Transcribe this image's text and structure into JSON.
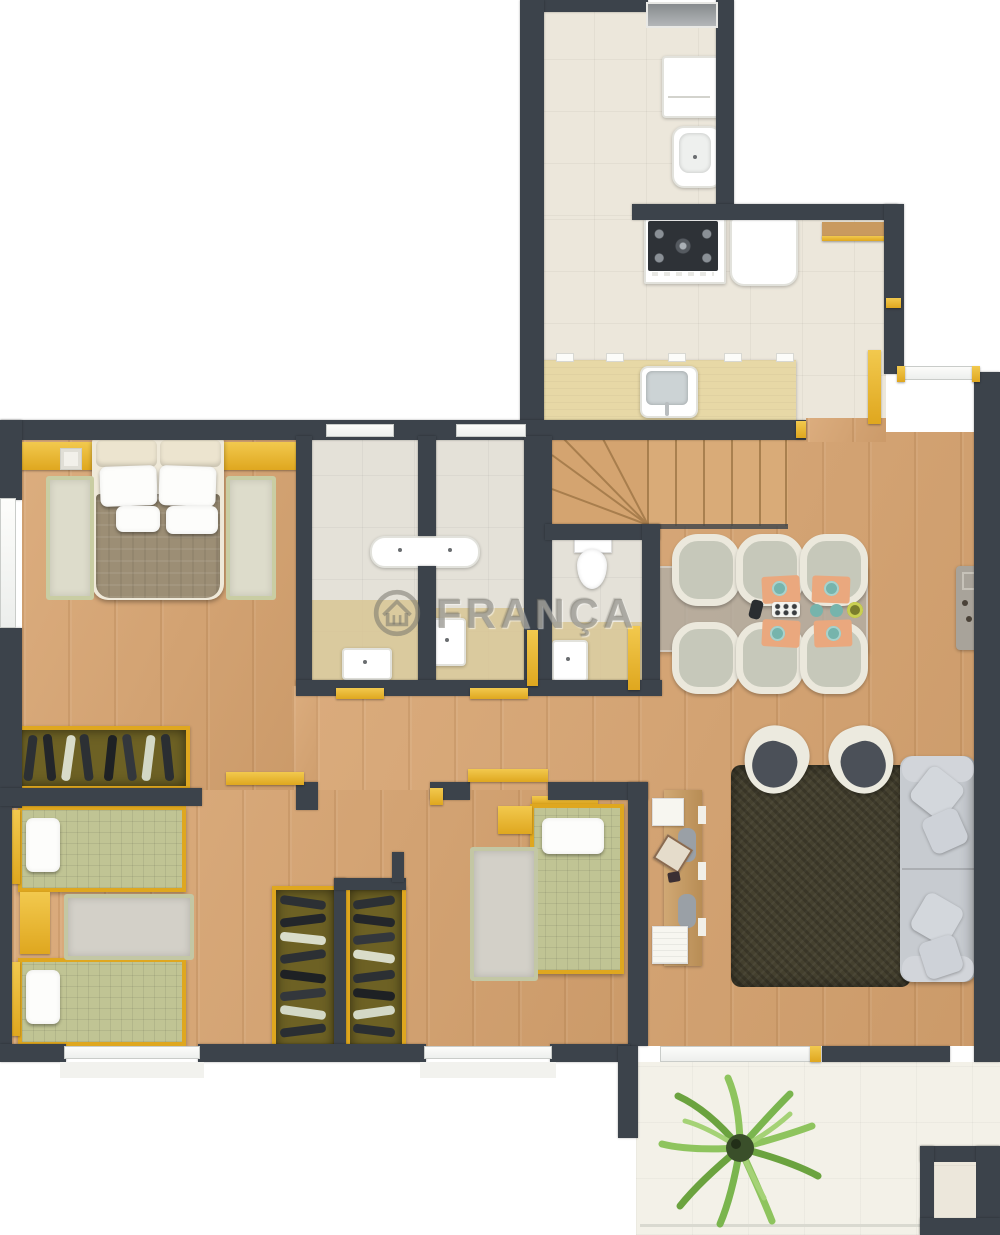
{
  "watermark": {
    "text": "FRANÇA",
    "logo": "house-in-circle-logo"
  },
  "colors": {
    "wall": "#3c434b",
    "wood": "#d8a470",
    "tileKitchen": "#ece7db",
    "tileBath": "#e4e1d8",
    "tan": "#d8c694",
    "balcony": "#f3f1e8",
    "gold": "#dfa71f",
    "goldLight": "#f2c94e",
    "sage": "#c0c494",
    "taupe": "#9c8e75",
    "sofa": "#c7cbd0",
    "rugDark": "#45412f",
    "rugGray": "#d3d0c8",
    "counter": "#e7d8a6",
    "peach": "#eaa87e",
    "teal": "#76b4ac",
    "watermarkGray": "#7d7b73",
    "plantGreen": "#8ec45e"
  },
  "rooms": [
    {
      "id": "service-area"
    },
    {
      "id": "kitchen"
    },
    {
      "id": "stairs"
    },
    {
      "id": "dining-area"
    },
    {
      "id": "living-room"
    },
    {
      "id": "master-bedroom"
    },
    {
      "id": "bathroom-1"
    },
    {
      "id": "bathroom-2"
    },
    {
      "id": "wc"
    },
    {
      "id": "hall"
    },
    {
      "id": "bedroom-2"
    },
    {
      "id": "bedroom-3"
    },
    {
      "id": "balcony"
    }
  ]
}
